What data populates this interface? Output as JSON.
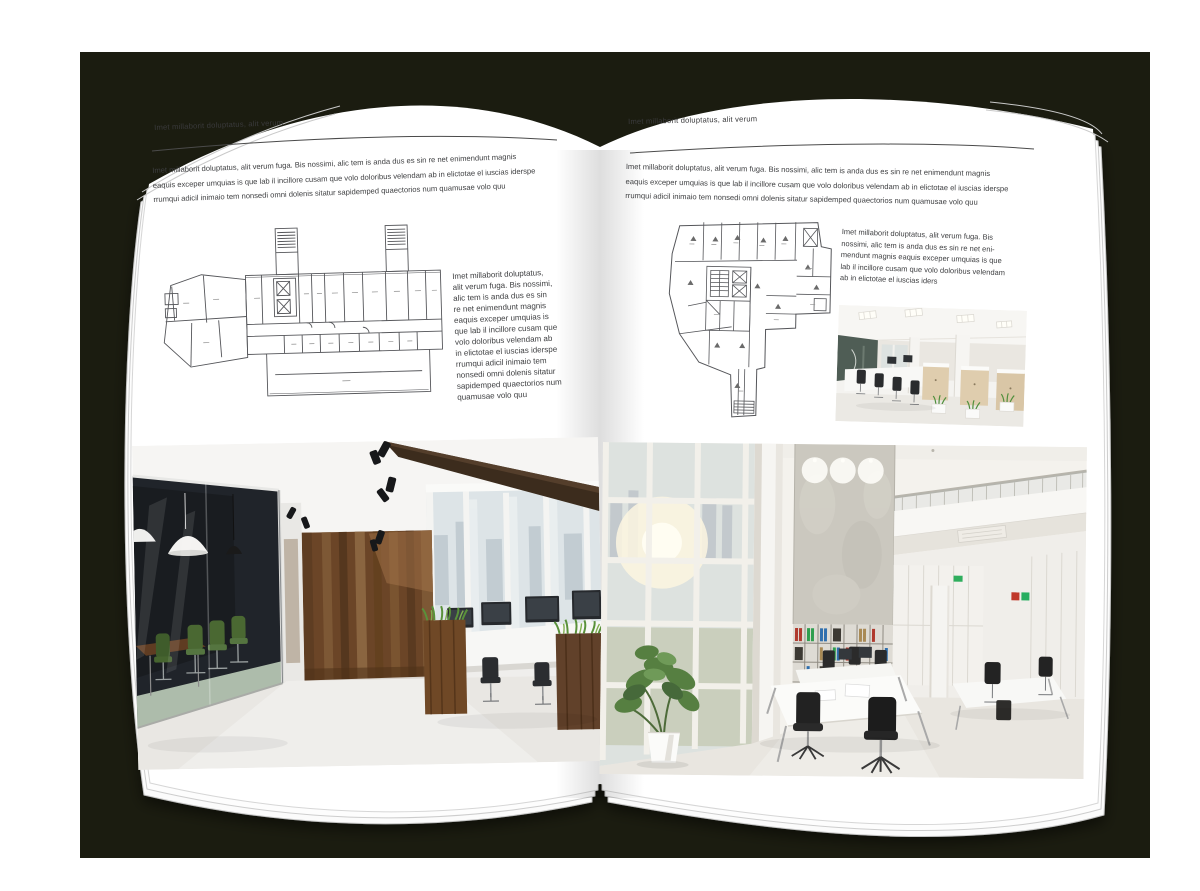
{
  "scene": {
    "backdrop_color": "#1b1c10",
    "canvas_color": "#ffffff",
    "page_color": "#ffffff"
  },
  "palette": {
    "body_text": "#3d3e40",
    "rule_line": "#4b4b4b",
    "plan_line": "#55565a",
    "wood_wall": "#6b4527",
    "beam_wood": "#3c2c1d",
    "meeting_room_dark": "#20242a",
    "chair_green": "#4a6832",
    "grass_green": "#59913a",
    "binder_red": "#b03a2e",
    "binder_green": "#2f9e4f",
    "binder_blue": "#2f6fae",
    "concrete_wall": "#cbc8bf",
    "floor_light": "#e9e6e0"
  },
  "left_page": {
    "running_head": "Imet millaborit doluptatus, alit verum",
    "intro": "Imet millaborit doluptatus, alit verum fuga. Bis nossimi, alic tem is anda dus es sin re net enimendunt magnis\neaquis exceper umquias is que lab il incillore cusam que volo doloribus velendam ab in elictotae el iuscias iderspe\nrrumqui adicil inimaio tem nonsedi omni dolenis sitatur sapidemped quaectorios num quamusae volo quu",
    "side_text": "Imet millaborit doluptatus,\nalit verum fuga. Bis nossimi,\nalic tem is anda dus es sin\nre net enimendunt magnis\neaquis exceper umquias is\nque lab il incillore cusam que\nvolo doloribus velendam ab\nin elictotae el iuscias iderspe\nrrumqui adicil inimaio tem\nnonsedi omni dolenis sitatur\nsapidemped quaectorios num\nquamusae volo quu"
  },
  "right_page": {
    "running_head": "Imet millaborit doluptatus, alit verum",
    "intro": "Imet millaborit doluptatus, alit verum fuga. Bis nossimi, alic tem is anda dus es sin re net enimendunt magnis\neaquis exceper umquias is que lab il incillore cusam que volo doloribus velendam ab in elictotae el iuscias iderspe\nrrumqui adicil inimaio tem nonsedi omni dolenis sitatur sapidemped quaectorios num quamusae volo quu",
    "side_text": "Imet millaborit doluptatus, alit verum fuga. Bis\nnossimi, alic tem is anda dus es sin re net eni-\nmendunt magnis eaquis exceper umquias is que\nlab il incillore cusam que volo doloribus velendam\nab in elictotae el iuscias iders"
  }
}
